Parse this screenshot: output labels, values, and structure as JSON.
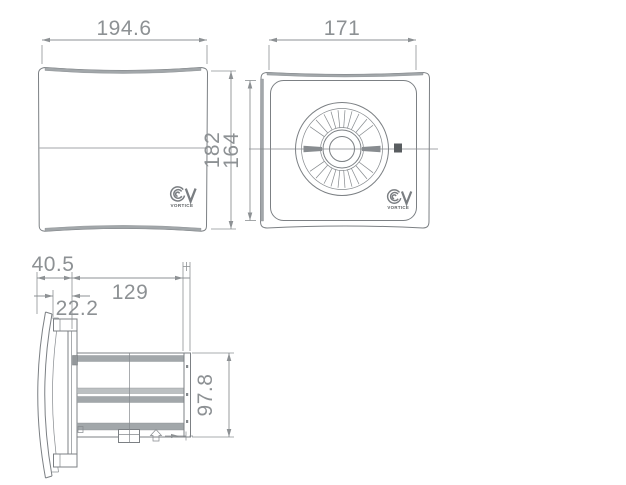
{
  "drawing": {
    "type": "technical-dimension-drawing",
    "product": "wall axial fan",
    "brand": "VORTICE",
    "views": [
      {
        "id": "front",
        "name": "front cover view",
        "dims": {
          "width": "194.6",
          "height": "182"
        }
      },
      {
        "id": "face",
        "name": "front view with impeller",
        "dims": {
          "width": "171",
          "height": "164"
        }
      },
      {
        "id": "side",
        "name": "side profile view",
        "dims": {
          "overall_depth": "40.5",
          "cover_depth": "22.2",
          "duct_length": "129",
          "duct_diameter": "97.8"
        }
      }
    ],
    "colors": {
      "line": "#7c8084",
      "dim_text": "#8d9194",
      "band": "#a2a7aa",
      "dark": "#595d60"
    }
  },
  "labels": {
    "front_width": "194.6",
    "front_height": "182",
    "face_width": "171",
    "face_height": "164",
    "side_depth": "40.5",
    "side_cover_depth": "22.2",
    "side_duct_length": "129",
    "side_duct_diameter": "97.8",
    "brand_front": "VORTICE",
    "brand_face": "VORTICE"
  }
}
